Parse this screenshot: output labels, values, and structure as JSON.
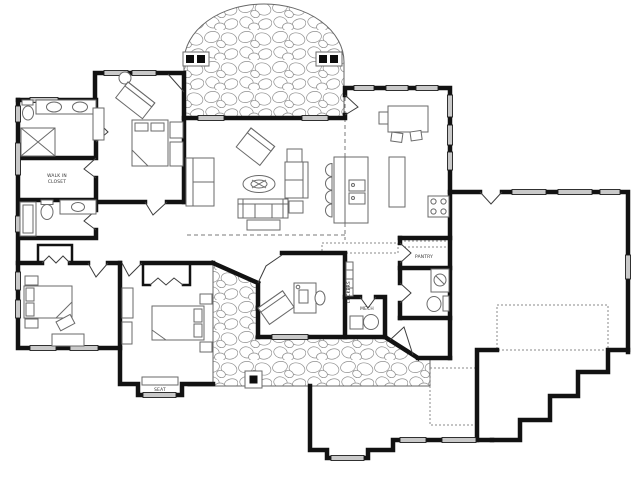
{
  "plan": {
    "type": "single-level-home-floor-plan",
    "labels": {
      "walk_in_closet_line1": "WALK IN",
      "walk_in_closet_line2": "CLOSET",
      "pantry": "PANTRY",
      "lockers": "LOCKERS",
      "mech": "MECH",
      "seat": "SEAT"
    },
    "colors": {
      "bg": "#ffffff",
      "wall": "#121212",
      "furn": "#6a6a6a",
      "winfill": "#c9c9c9",
      "stone": "#8f8f8f",
      "dash": "#7a7a7a",
      "label": "#333333"
    }
  }
}
